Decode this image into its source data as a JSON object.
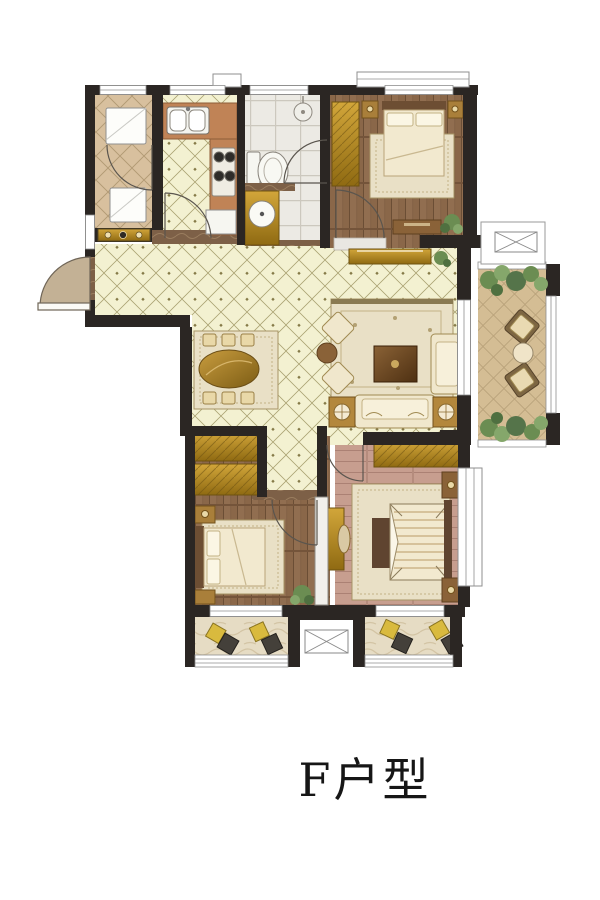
{
  "title": {
    "label": "F户型"
  },
  "plan": {
    "name": "apartment-floor-plan-unit-f",
    "rooms": [
      "utility-room",
      "kitchen",
      "bathroom",
      "bedroom-top-right",
      "entry-hall",
      "dining-room",
      "living-room",
      "hallway",
      "bedroom-bottom-left",
      "master-bedroom",
      "balcony-right",
      "balcony-bottom-left",
      "balcony-bottom-right"
    ],
    "fixtures": [
      "entry-door-swing",
      "kitchen-sink",
      "cooktop",
      "refrigerator",
      "washing-machine",
      "toilet",
      "shower-head",
      "vanity-sink",
      "dining-table",
      "sofa-set",
      "tv-console",
      "double-bed",
      "wardrobe",
      "nightstand",
      "duct-shaft",
      "patio-chairs",
      "plants"
    ]
  },
  "icons": {
    "duct-shaft-icon": "rectangle-with-x-cross",
    "shower-head-icon": "circle-with-stem",
    "door-swing-icon": "quarter-circle-arc",
    "lamp-icon": "circle-with-spokes"
  },
  "colors": {
    "wall": "#2b2623",
    "tile_floor": "#f3f1d1",
    "tile_line": "#a9a171",
    "wood_floor": "#8a6749",
    "master_floor": "#c79e8f",
    "utility_tile": "#d8c09e",
    "bath_tile": "#eceae4",
    "balcony_tile": "#d4bd94",
    "balcony_marble": "#e6dcc4",
    "counter": "#c08356",
    "gold_furniture": "#bd8f26",
    "rug": "#e9e0c6",
    "cream_furniture": "#f0e7cc",
    "threshold_marble": "#7d6047",
    "entry_marble": "#c3b195",
    "plant_green": "#6b8d52",
    "cushion_yellow": "#d9ba3e",
    "title_text": "#161616"
  }
}
